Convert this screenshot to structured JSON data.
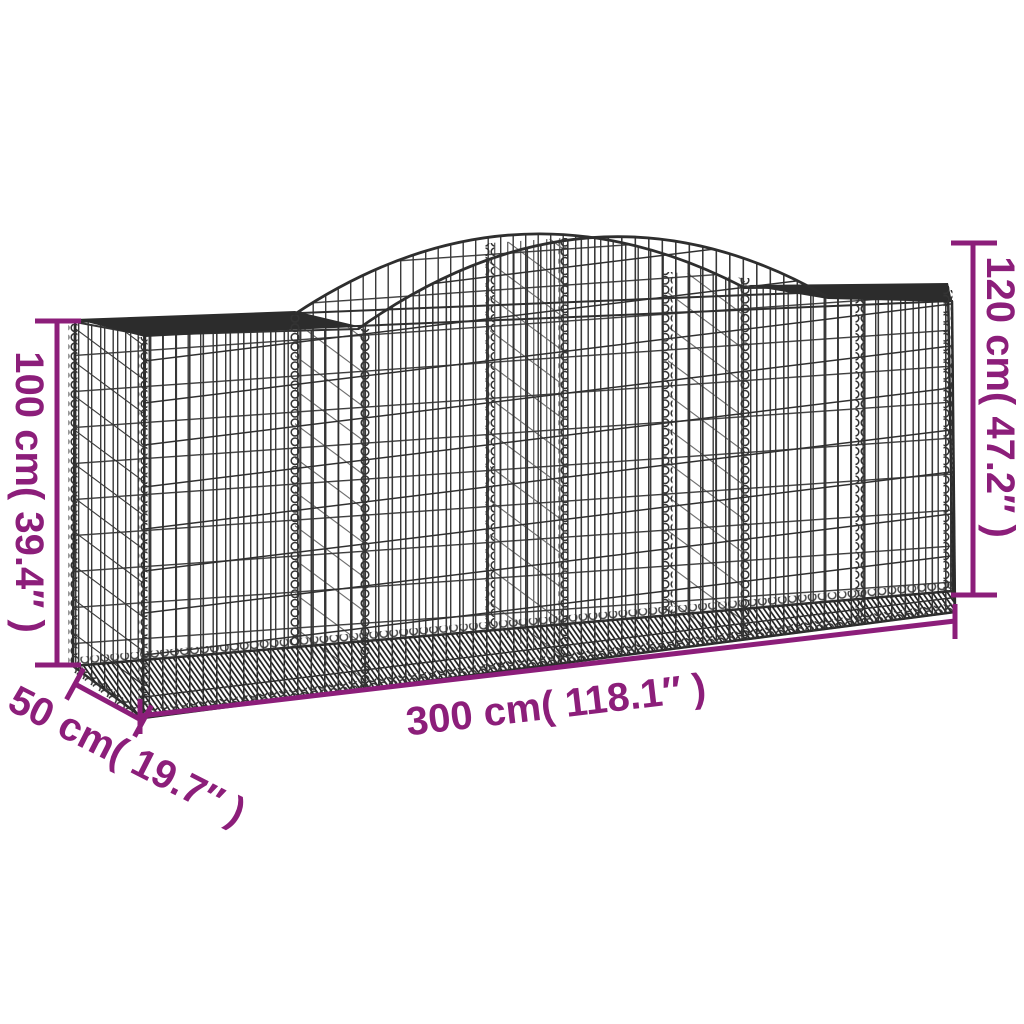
{
  "page": {
    "background": "#ffffff"
  },
  "diagram": {
    "subject": "arched gabion basket dimension drawing",
    "colors": {
      "annotation": "#8c1e7a",
      "wire": "#333333",
      "frame": "#2c2c2c",
      "background": "#ffffff"
    },
    "labels": {
      "height_left": "100 cm( 39.4″ )",
      "height_right": "120 cm( 47.2″ )",
      "length": "300 cm( 118.1″ )",
      "depth": "50 cm( 19.7″ )"
    }
  }
}
